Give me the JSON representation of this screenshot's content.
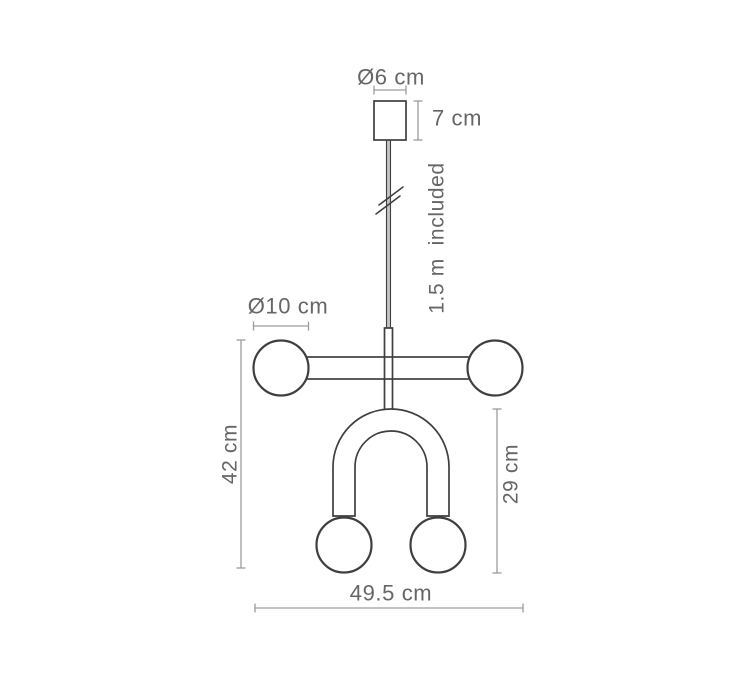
{
  "diagram": {
    "title": "Pendant lamp dimension drawing",
    "labels": {
      "canopy_diameter": "Ø6 cm",
      "canopy_height": "7 cm",
      "cable_length": "1.5 m  included",
      "sphere_diameter": "Ø10 cm",
      "total_height": "42 cm",
      "u_tube_height": "29 cm",
      "total_width": "49.5 cm"
    },
    "colors": {
      "background": "#ffffff",
      "line": "#3f3f3f",
      "dimension": "#9c9c9c",
      "text": "#666666",
      "cable_fill": "#c4c4c4"
    }
  }
}
